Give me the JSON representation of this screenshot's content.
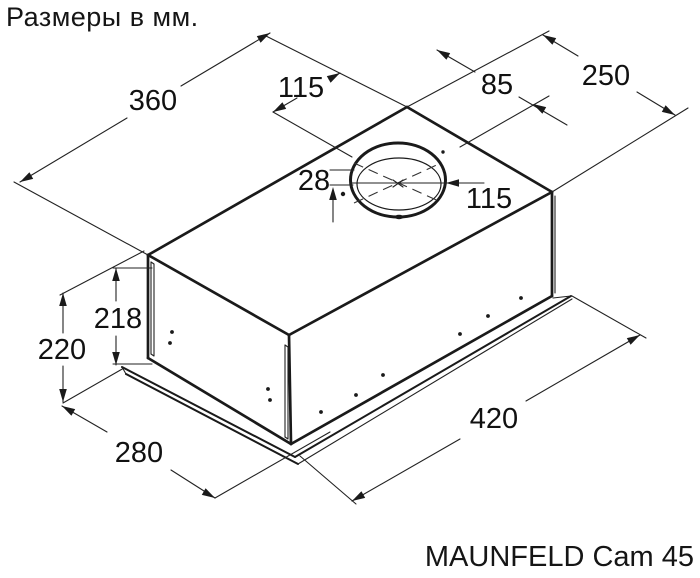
{
  "page": {
    "title": "Размеры в мм.",
    "model_label": "MAUNFELD Cam 45"
  },
  "drawing": {
    "type": "isometric dimension drawing of built-in cooker hood body",
    "units": "мм",
    "colors": {
      "line": "#1a1a1a",
      "text": "#111111",
      "background": "#ffffff"
    },
    "dimensions": {
      "top_face_width": {
        "value": "360"
      },
      "duct_offset_front": {
        "value": "115"
      },
      "duct_offset_rear": {
        "value": "85"
      },
      "top_face_depth": {
        "value": "250"
      },
      "duct_hole_offset": {
        "value": "28"
      },
      "duct_diameter": {
        "value": "115"
      },
      "body_height": {
        "value": "218"
      },
      "total_height": {
        "value": "220"
      },
      "bottom_panel_depth": {
        "value": "280"
      },
      "bottom_panel_width": {
        "value": "420"
      }
    }
  }
}
